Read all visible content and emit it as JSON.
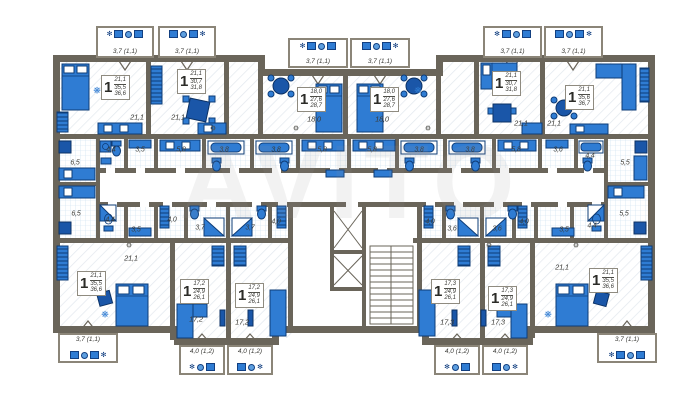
{
  "plan": {
    "watermark": "AVITO",
    "colors": {
      "wall": "#6a655a",
      "balcony_wall": "#8b8578",
      "furniture": "#2f7cd3",
      "furniture_dark": "#123f80",
      "floor_grid": "#c9dff0",
      "floor_hatch": "#e2e8ee",
      "label_text": "#3b3b37"
    },
    "apartments": [
      {
        "id": "top-left",
        "rooms": "1",
        "living": "21,1",
        "area": "35,5",
        "total": "36,6",
        "room_area": "21,1",
        "balcony": "3,7 (1,1)"
      },
      {
        "id": "top-2",
        "rooms": "1",
        "living": "21,1",
        "area": "30,7",
        "total": "31,8",
        "room_area": "21,1",
        "balcony": "3,7 (1,1)"
      },
      {
        "id": "top-center-l",
        "rooms": "1",
        "living": "18,0",
        "area": "27,6",
        "total": "28,7",
        "room_area": "18,0",
        "balcony": "3,7 (1,1)"
      },
      {
        "id": "top-center-r",
        "rooms": "1",
        "living": "18,0",
        "area": "27,6",
        "total": "28,7",
        "room_area": "18,0",
        "balcony": "3,7 (1,1)"
      },
      {
        "id": "top-5",
        "rooms": "1",
        "living": "21,1",
        "area": "30,7",
        "total": "31,8",
        "room_area": "21,1",
        "balcony": "3,7 (1,1)"
      },
      {
        "id": "top-right",
        "rooms": "1",
        "living": "21,1",
        "area": "35,6",
        "total": "36,7",
        "room_area": "21,1",
        "balcony": "3,7 (1,1)"
      },
      {
        "id": "bottom-left",
        "rooms": "1",
        "living": "21,1",
        "area": "35,5",
        "total": "36,6",
        "room_area": "21,1",
        "balcony": "3,7 (1,1)"
      },
      {
        "id": "bottom-2",
        "rooms": "1",
        "living": "17,2",
        "area": "24,9",
        "total": "26,1",
        "room_area": "17,2",
        "balcony": "4,0 (1,2)"
      },
      {
        "id": "bottom-3",
        "rooms": "1",
        "living": "17,2",
        "area": "24,9",
        "total": "26,1",
        "room_area": "17,2",
        "balcony": "4,0 (1,2)"
      },
      {
        "id": "bottom-4",
        "rooms": "1",
        "living": "17,3",
        "area": "24,9",
        "total": "26,1",
        "room_area": "17,3",
        "balcony": "4,0 (1,2)"
      },
      {
        "id": "bottom-5",
        "rooms": "1",
        "living": "17,3",
        "area": "24,9",
        "total": "26,1",
        "room_area": "17,3",
        "balcony": "4,0 (1,2)"
      },
      {
        "id": "bottom-right",
        "rooms": "1",
        "living": "21,1",
        "area": "35,5",
        "total": "36,6",
        "room_area": "21,1",
        "balcony": "3,7 (1,1)"
      }
    ],
    "service_rooms_upper": [
      "6,5",
      "4,4",
      "3,5",
      "5,8",
      "3,8",
      "3,8",
      "5,8",
      "5,8",
      "3,8",
      "3,8",
      "5,8",
      "3,6",
      "4,4",
      "5,5"
    ],
    "service_rooms_lower": [
      "6,5",
      "4,4",
      "3,5",
      "4,0",
      "3,7",
      "3,7",
      "4,0",
      "4,0",
      "3,6",
      "3,6",
      "4,0",
      "3,5",
      "4,4",
      "5,5"
    ]
  }
}
